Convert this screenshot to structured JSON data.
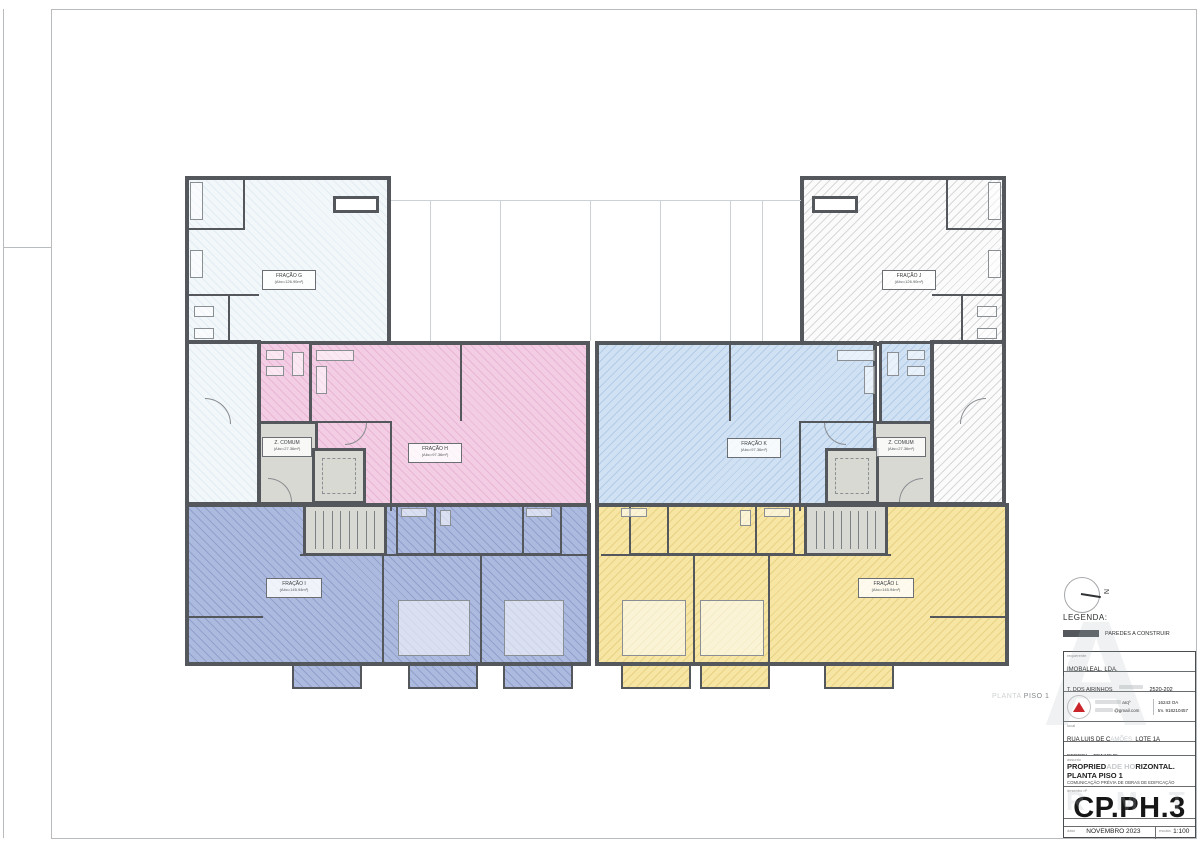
{
  "colors": {
    "wall": "#54585c",
    "unit_g": "#f2f7fa",
    "unit_h": "#f3cde3",
    "unit_i": "#adbadf",
    "unit_j": "#fbfbfb",
    "unit_k": "#cfe1f3",
    "unit_l": "#f6e5a3",
    "common_zone": "#d9d9d4",
    "logo_red": "#c9252b"
  },
  "plan": {
    "floor_tag": {
      "light": "PLANTA",
      "dark": "PISO 1"
    },
    "units": [
      {
        "label": "FRAÇÃO G",
        "area": "(Abc=126.90m²)"
      },
      {
        "label": "FRAÇÃO H",
        "area": "(Abc=97.36m²)"
      },
      {
        "label": "FRAÇÃO I",
        "area": "(Abc=145.94m²)"
      },
      {
        "label": "FRAÇÃO J",
        "area": "(Abc=126.90m²)"
      },
      {
        "label": "FRAÇÃO K",
        "area": "(Abc=97.36m²)"
      },
      {
        "label": "FRAÇÃO L",
        "area": "(Abc=145.94m²)"
      },
      {
        "label": "Z. COMUM",
        "area": "(Abc=27.36m²)"
      },
      {
        "label": "Z. COMUM",
        "area": "(Abc=27.36m²)"
      }
    ]
  },
  "legend": {
    "title": "LEGENDA:",
    "walls_item": "PAREDES A CONSTRUIR"
  },
  "north": {
    "letter": "N"
  },
  "titleblock": {
    "requerente_label": "requerente",
    "requerente": "IMOBALEAL, LDA.",
    "address_left": "T. DOS AIRINHOS",
    "address_right": "2520-202 PENICHE",
    "arch_title": "arqº",
    "arch_reg": "16243 OA",
    "arch_email": "@gmail.com",
    "arch_phone": "tm. 918210457",
    "local_label": "local",
    "local_a": "RUA LUIS DE C",
    "local_b": "AMÕES,",
    "local_c": " LOTE 1A",
    "parish": "FERREL - PENICHE",
    "subject_label": "assunto",
    "subject1_a": "PROPRIED",
    "subject1_b": "ADE HO",
    "subject1_c": "RIZONTAL.",
    "subject2": "PLANTA PISO 1",
    "subject3": "COMUNICAÇÃO PRÉVIA DE OBRAS DE EDIFICAÇÃO",
    "number_label": "desenho nº",
    "number": "CP.PH.3",
    "date_label": "data",
    "date": "NOVEMBRO 2023",
    "scale_label": "escala",
    "scale": "1:100"
  },
  "watermark": {
    "big": "A",
    "fragments": "R M T"
  }
}
